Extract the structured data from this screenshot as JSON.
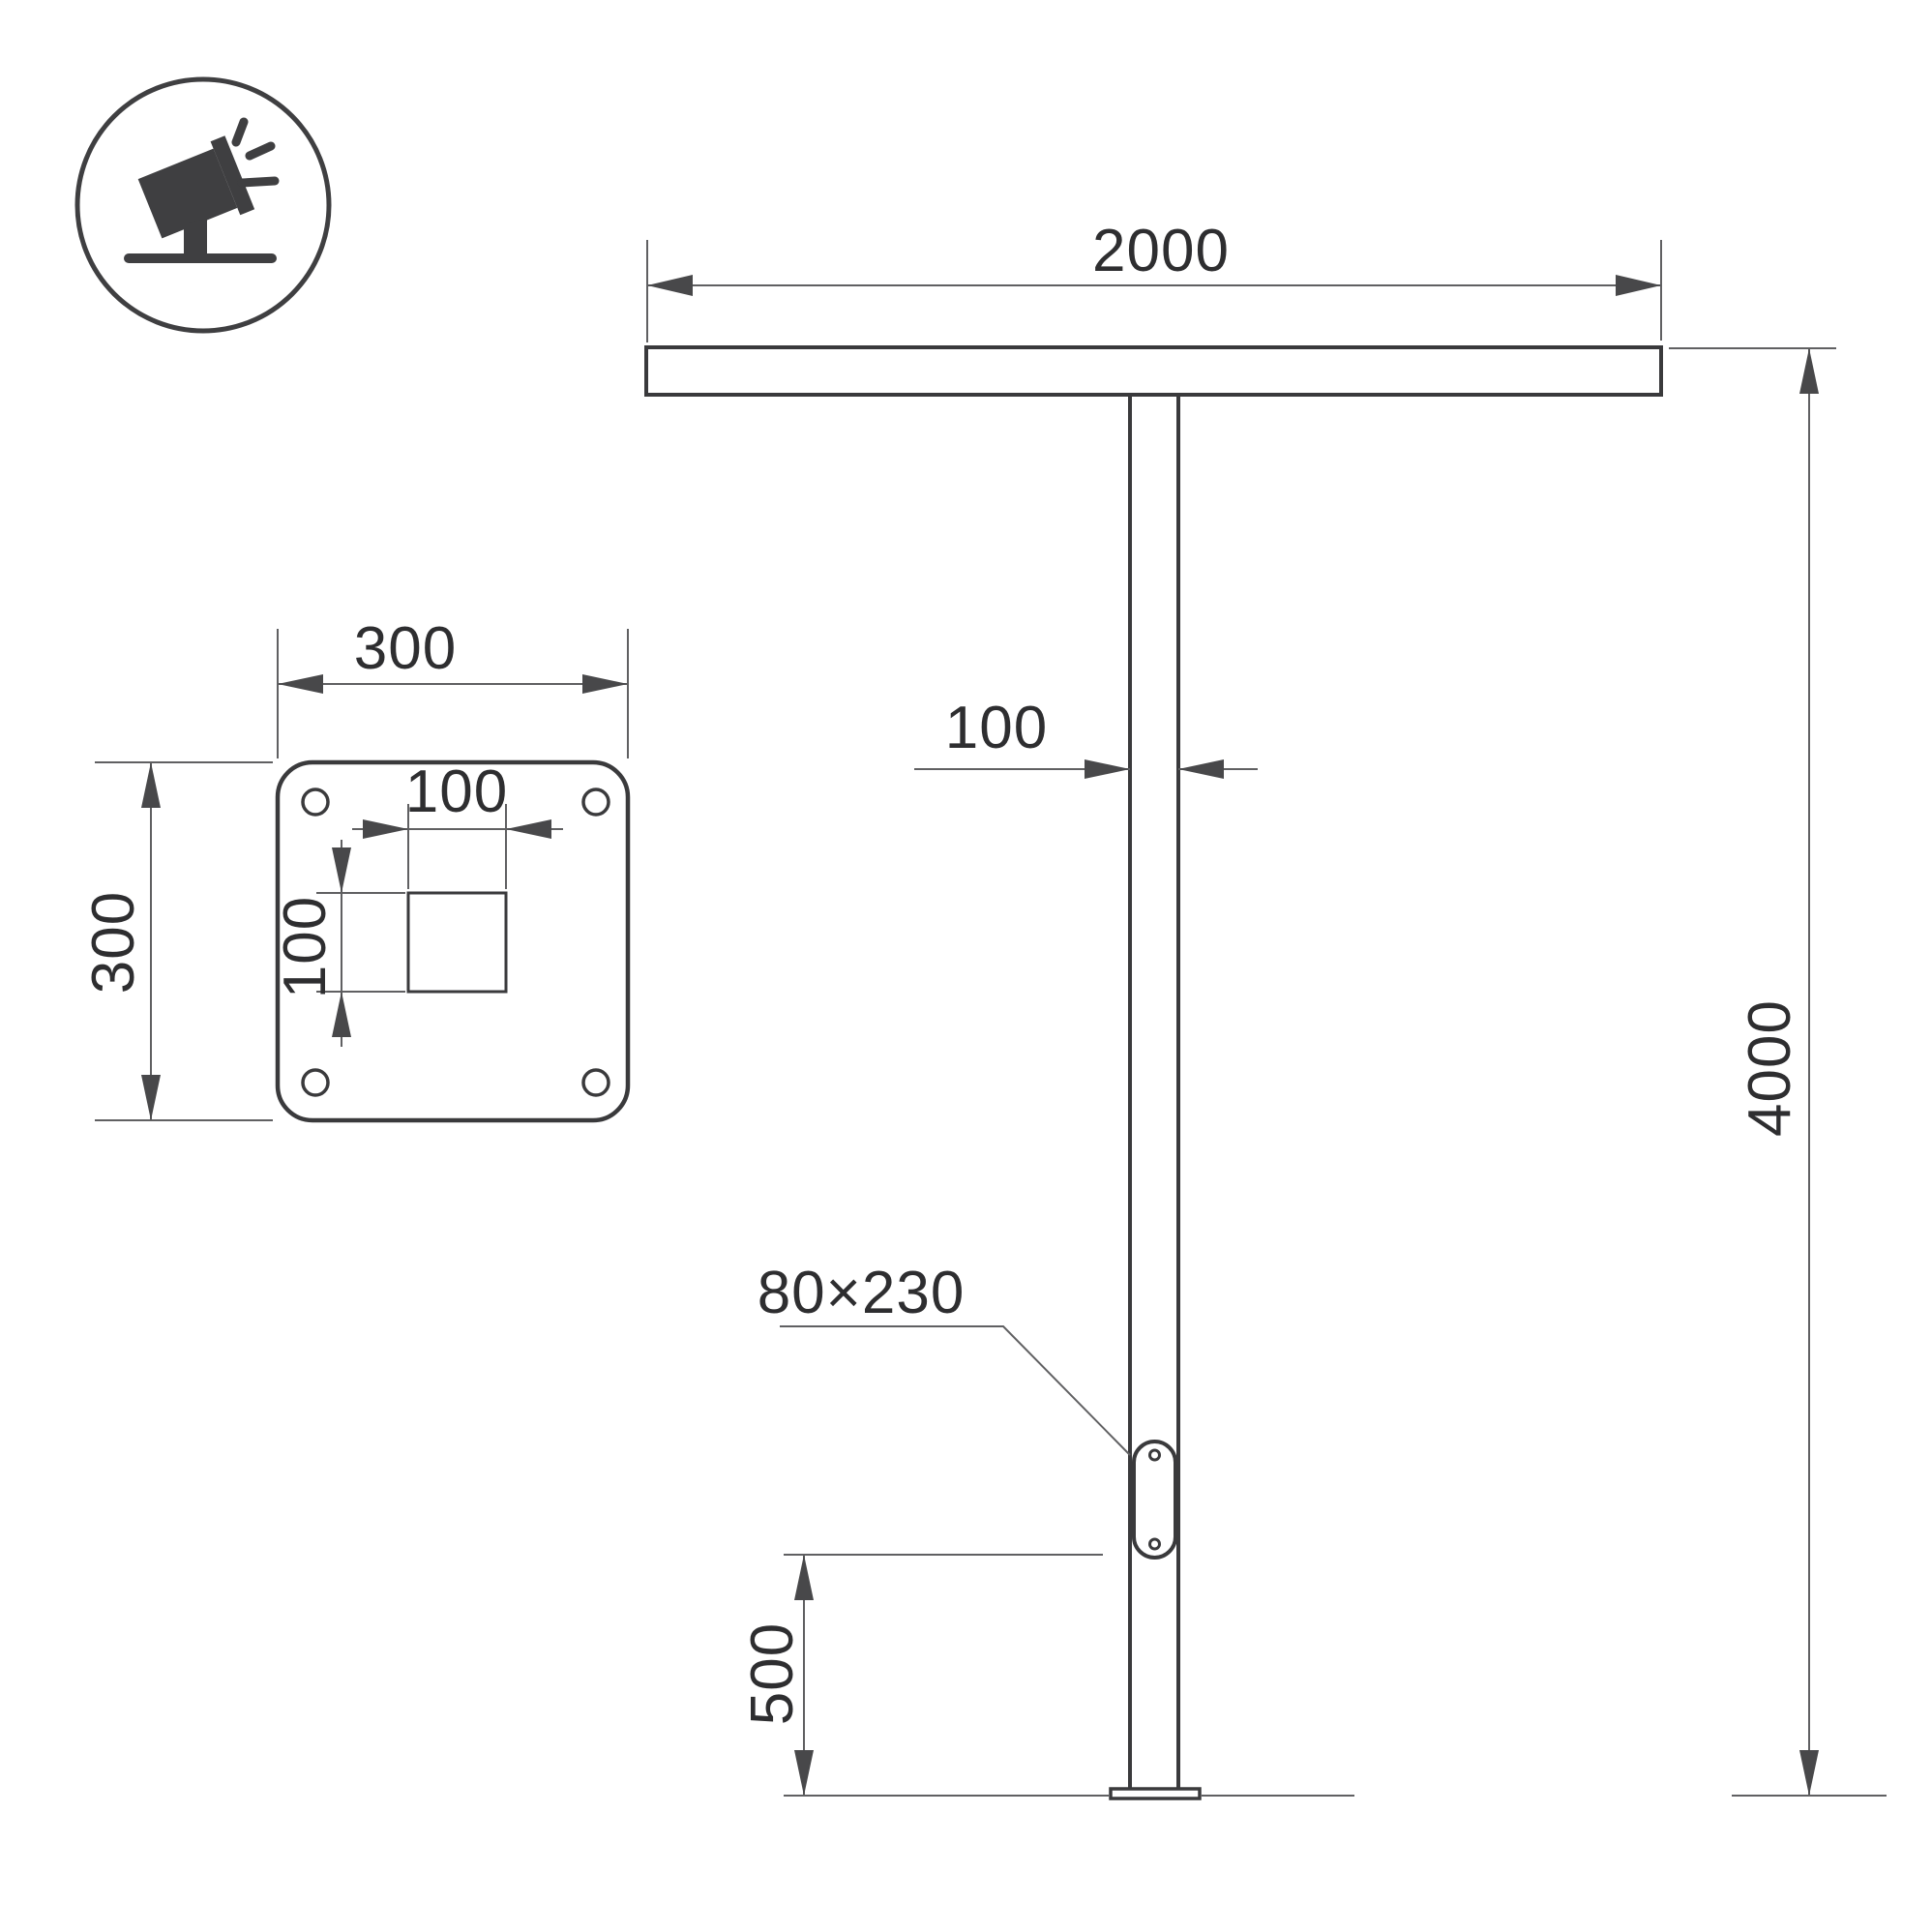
{
  "drawing": {
    "type": "technical-drawing",
    "views": [
      "base-plate-plan",
      "pole-elevation"
    ],
    "icon": "tilted-floodlight-on-stand"
  },
  "labels": {
    "crossbar_width": "2000",
    "pole_width": "100",
    "pole_height": "4000",
    "hatch_size": "80×230",
    "hatch_height": "500",
    "plate_width": "300",
    "plate_height": "300",
    "hole_width": "100",
    "hole_height": "100"
  },
  "colors": {
    "object_line": "#3a3a3c",
    "dimension_line": "#606062",
    "arrow_fill": "#48484a",
    "icon_fill": "#3f3f41",
    "text": "#2e2e30",
    "background": "#ffffff"
  }
}
